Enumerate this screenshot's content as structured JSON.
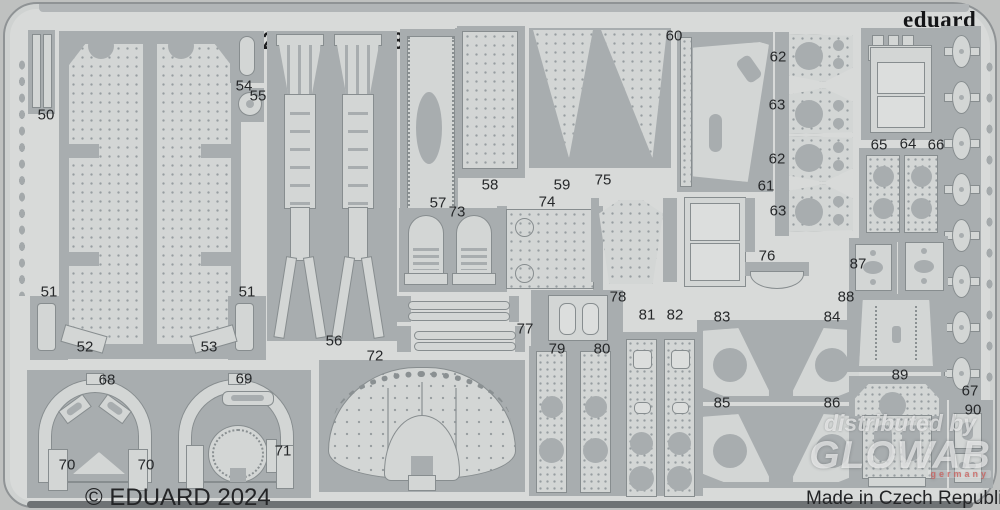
{
  "header": {
    "title": "49 1441 Buccaneer S.2B Gulf War 1/48",
    "brand": "eduard"
  },
  "footer": {
    "copyright": "© EDUARD 2024",
    "made_in": "Made in Czech Republic"
  },
  "watermark": {
    "line1": "distributed by",
    "line2": "GLOWAB",
    "line3": "germany"
  },
  "colors": {
    "metal_frame": "#a8adaf",
    "metal_part": "#d3d6d5",
    "sheet_background": "#d8dad9",
    "photo_background": "#bfc1c0",
    "text": "#1f2022",
    "watermark": "rgba(255,255,255,0.62)"
  },
  "parts": {
    "labels": [
      {
        "n": "50",
        "x": 41,
        "y": 111
      },
      {
        "n": "54",
        "x": 239,
        "y": 82
      },
      {
        "n": "55",
        "x": 253,
        "y": 92
      },
      {
        "n": "51",
        "x": 44,
        "y": 288
      },
      {
        "n": "51",
        "x": 242,
        "y": 288
      },
      {
        "n": "52",
        "x": 80,
        "y": 343
      },
      {
        "n": "53",
        "x": 204,
        "y": 343
      },
      {
        "n": "56",
        "x": 329,
        "y": 337
      },
      {
        "n": "72",
        "x": 370,
        "y": 352
      },
      {
        "n": "57",
        "x": 433,
        "y": 199
      },
      {
        "n": "73",
        "x": 452,
        "y": 208
      },
      {
        "n": "58",
        "x": 485,
        "y": 181
      },
      {
        "n": "74",
        "x": 542,
        "y": 198
      },
      {
        "n": "59",
        "x": 557,
        "y": 181
      },
      {
        "n": "75",
        "x": 598,
        "y": 176
      },
      {
        "n": "60",
        "x": 669,
        "y": 32
      },
      {
        "n": "61",
        "x": 761,
        "y": 182
      },
      {
        "n": "62",
        "x": 773,
        "y": 53
      },
      {
        "n": "63",
        "x": 772,
        "y": 101
      },
      {
        "n": "62",
        "x": 772,
        "y": 155
      },
      {
        "n": "63",
        "x": 773,
        "y": 207
      },
      {
        "n": "65",
        "x": 874,
        "y": 141
      },
      {
        "n": "64",
        "x": 903,
        "y": 140
      },
      {
        "n": "66",
        "x": 931,
        "y": 141
      },
      {
        "n": "87",
        "x": 853,
        "y": 260
      },
      {
        "n": "88",
        "x": 841,
        "y": 293
      },
      {
        "n": "76",
        "x": 762,
        "y": 252
      },
      {
        "n": "78",
        "x": 613,
        "y": 293
      },
      {
        "n": "77",
        "x": 520,
        "y": 325
      },
      {
        "n": "79",
        "x": 552,
        "y": 345
      },
      {
        "n": "80",
        "x": 597,
        "y": 345
      },
      {
        "n": "81",
        "x": 642,
        "y": 311
      },
      {
        "n": "82",
        "x": 670,
        "y": 311
      },
      {
        "n": "83",
        "x": 717,
        "y": 313
      },
      {
        "n": "84",
        "x": 827,
        "y": 313
      },
      {
        "n": "85",
        "x": 717,
        "y": 399
      },
      {
        "n": "86",
        "x": 827,
        "y": 399
      },
      {
        "n": "68",
        "x": 102,
        "y": 376
      },
      {
        "n": "69",
        "x": 239,
        "y": 375
      },
      {
        "n": "70",
        "x": 62,
        "y": 461
      },
      {
        "n": "70",
        "x": 141,
        "y": 461
      },
      {
        "n": "71",
        "x": 278,
        "y": 447
      },
      {
        "n": "89",
        "x": 895,
        "y": 371
      },
      {
        "n": "67",
        "x": 965,
        "y": 387
      },
      {
        "n": "90",
        "x": 968,
        "y": 406
      }
    ]
  }
}
